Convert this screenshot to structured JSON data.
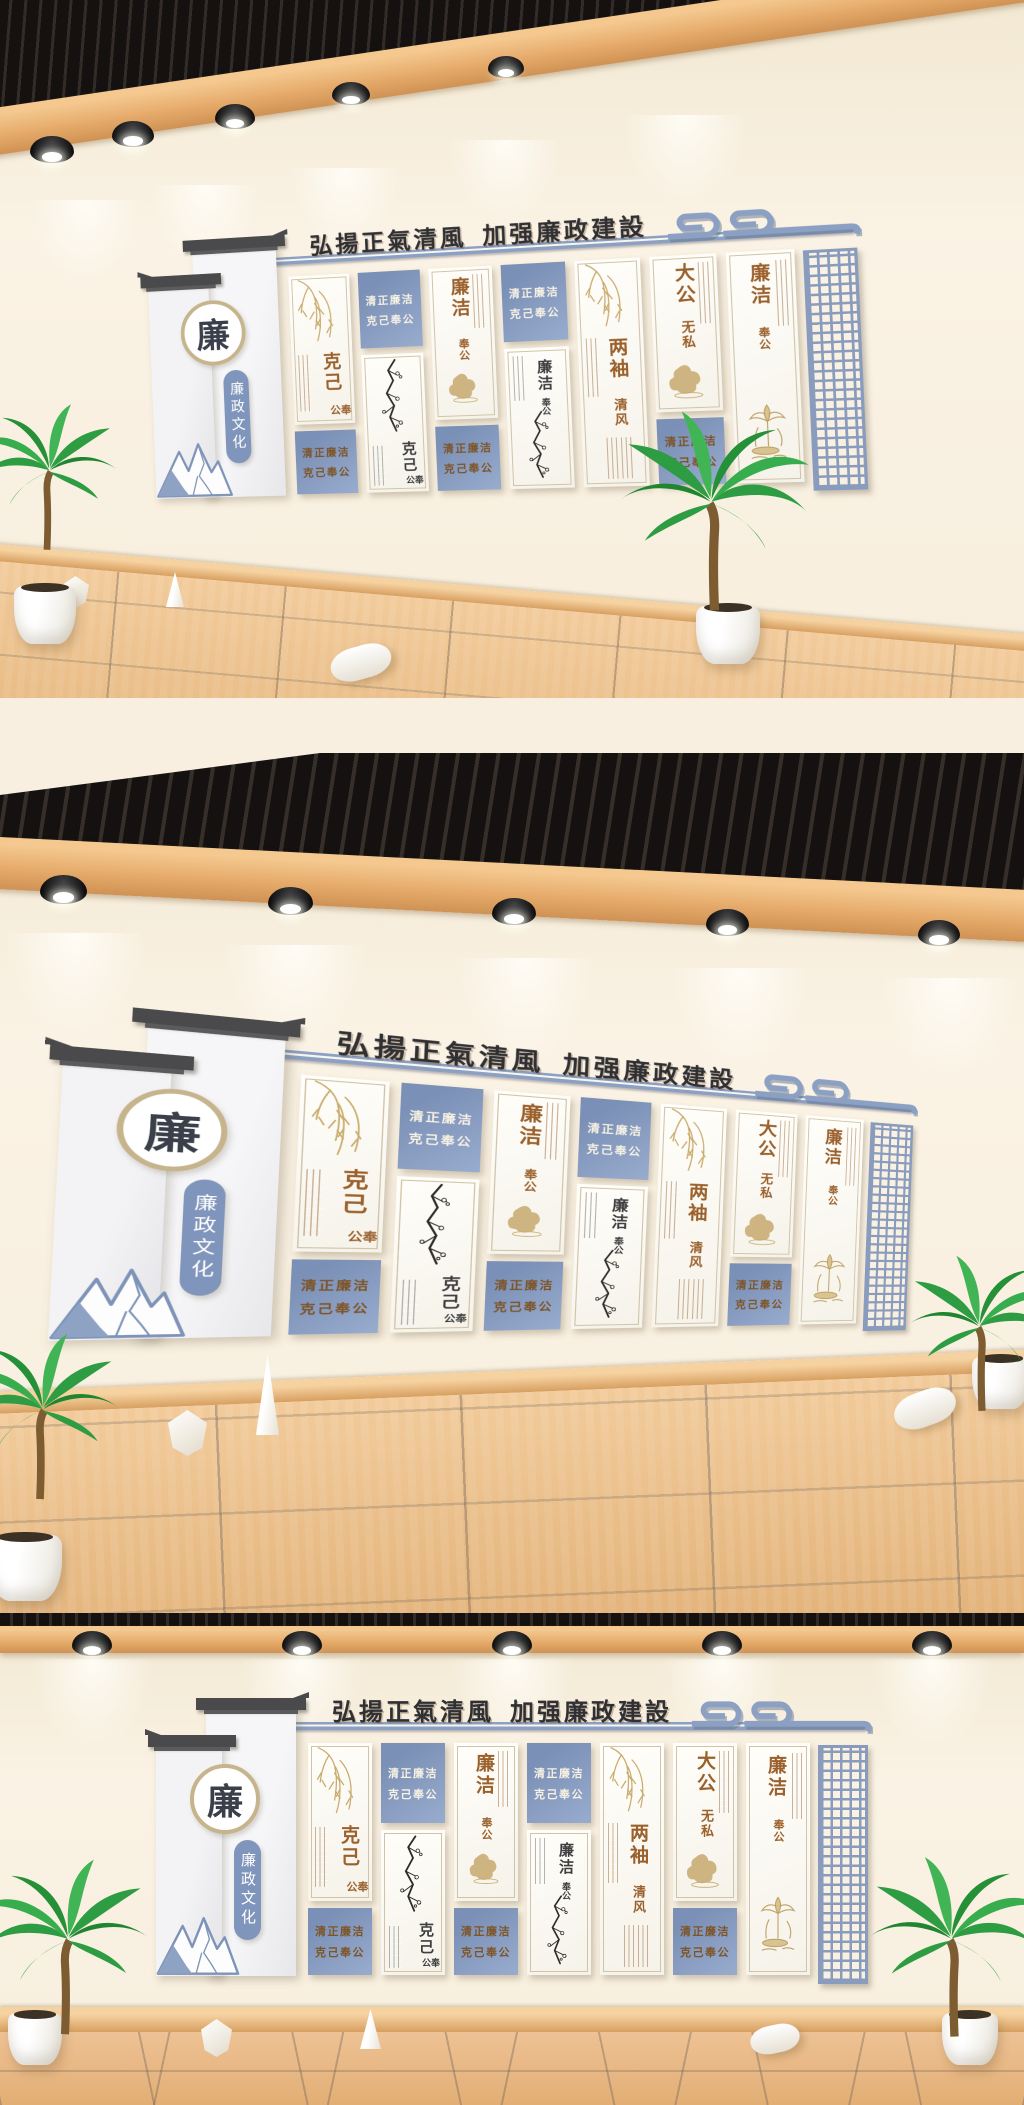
{
  "art": {
    "title": {
      "part1": "弘揚正氣清風",
      "part2": "加强廉政建設"
    },
    "banner": {
      "emblem": "廉",
      "pill": "廉政文化"
    },
    "slogan": {
      "line1": "清正廉洁",
      "line2": "克己奉公"
    },
    "columns": [
      {
        "heading": "克己",
        "subheading": "奉公",
        "tone": "brown",
        "art": "willow-branch-icon"
      },
      {
        "heading": "克己",
        "subheading": "奉公",
        "tone": "ink",
        "art": "plum-blossom-ink-icon"
      },
      {
        "heading": "廉洁",
        "subheading": "奉公",
        "tone": "brown",
        "art": "gold-ink-wash-icon"
      },
      {
        "heading": "廉洁",
        "subheading": "奉公",
        "tone": "ink",
        "art": "plum-blossom-ink-icon"
      },
      {
        "heading": "两袖",
        "subheading": "清风",
        "tone": "brown",
        "art": "willow-branch-icon"
      },
      {
        "heading": "大公",
        "subheading": "无私",
        "tone": "brown",
        "art": "gold-ink-wash-icon"
      },
      {
        "heading": "廉洁",
        "subheading": "奉公",
        "tone": "brown",
        "art": "gold-lotus-icon"
      }
    ],
    "decor": {
      "lattice": "lattice-screen-icon",
      "cloud": "cloud-motif-icon",
      "mountain": "blue-mountain-icon"
    },
    "colors": {
      "panel_blue": "#8095ba",
      "text_brown": "#9b612d",
      "text_ink": "#3e3e40",
      "gold": "#c5a96e",
      "bar_blue": "#8ba0c2",
      "title_ink": "#303136",
      "lattice_blue": "#8a9cbd"
    }
  },
  "scene": {
    "spotlight": "spotlight-icon",
    "plant": "palm-plant-icon",
    "objects": [
      "polyhedron-decor",
      "cone-decor",
      "cylinder-decor"
    ],
    "ceiling_color": "#241f1c",
    "beam_color": "#e2aa6e",
    "floor_color": "#eabc87",
    "wall_color": "#f8efe0"
  }
}
